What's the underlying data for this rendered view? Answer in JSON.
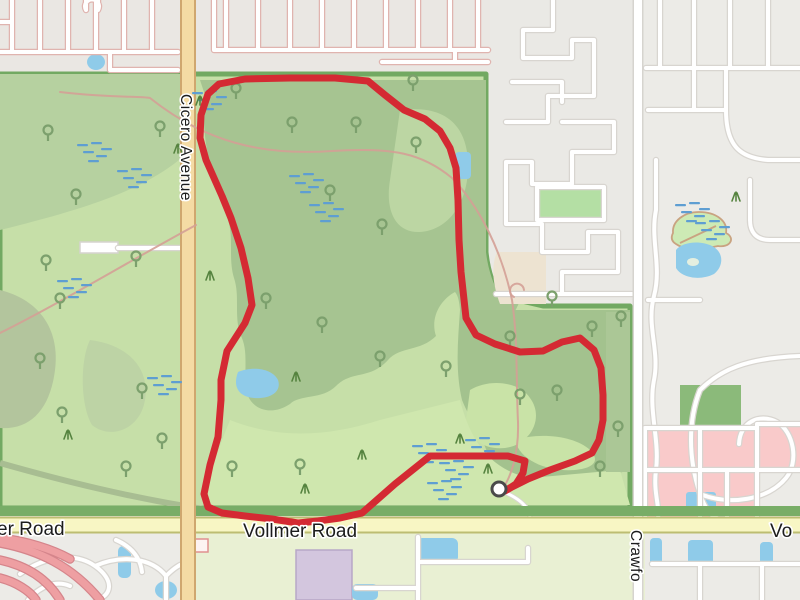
{
  "roads": {
    "cicero_label": "Cicero Avenue",
    "vollmer_label": "Vollmer Road",
    "vollmer_label_left_fragment": "er Road",
    "vollmer_label_right_fragment": "Vo",
    "crawford_label_fragment": "Crawfo"
  },
  "route": {
    "points": "505,491 516,484 523,473 525,461 508,456 470,456 430,456 395,484 362,513 340,518 318,521 298,523 272,519 245,516 222,513 208,507 204,494 210,465 218,437 221,400 221,380 227,351 245,323 252,305 248,278 241,248 231,218 222,196 206,160 200,138 201,115 208,94 219,84 245,79 290,78 335,78 368,81 385,95 404,110 425,119 440,131 450,148 456,168 458,200 459,240 461,272 466,318 476,335 495,344 520,352 543,351 562,342 580,338 594,350 601,368 603,395 603,420 599,440 592,453 575,461 550,470 528,479 512,487 505,491",
    "stroke_color": "#d42a33",
    "marker": {
      "x": 499,
      "y": 489,
      "fill": "#ffffff",
      "ring_color": "#4a4a4a",
      "radius": 7
    }
  },
  "park_symbols": {
    "trees": [
      [
        236,
        92
      ],
      [
        292,
        126
      ],
      [
        356,
        126
      ],
      [
        416,
        146
      ],
      [
        160,
        130
      ],
      [
        48,
        134
      ],
      [
        76,
        198
      ],
      [
        46,
        264
      ],
      [
        136,
        260
      ],
      [
        330,
        194
      ],
      [
        382,
        228
      ],
      [
        322,
        326
      ],
      [
        380,
        360
      ],
      [
        446,
        370
      ],
      [
        60,
        302
      ],
      [
        40,
        362
      ],
      [
        142,
        392
      ],
      [
        62,
        416
      ],
      [
        126,
        470
      ],
      [
        162,
        442
      ],
      [
        266,
        302
      ],
      [
        510,
        340
      ],
      [
        621,
        320
      ],
      [
        557,
        394
      ],
      [
        600,
        470
      ],
      [
        413,
        84
      ],
      [
        232,
        470
      ],
      [
        300,
        468
      ],
      [
        552,
        300
      ],
      [
        520,
        398
      ],
      [
        592,
        330
      ],
      [
        618,
        430
      ]
    ],
    "marsh_clusters": [
      [
        205,
        100
      ],
      [
        90,
        152
      ],
      [
        130,
        178
      ],
      [
        302,
        183
      ],
      [
        322,
        212
      ],
      [
        70,
        288
      ],
      [
        160,
        385
      ],
      [
        425,
        453
      ],
      [
        452,
        470
      ],
      [
        478,
        447
      ],
      [
        440,
        490
      ],
      [
        688,
        212
      ],
      [
        708,
        230
      ]
    ],
    "grass_tufts": [
      [
        178,
        150
      ],
      [
        210,
        277
      ],
      [
        296,
        378
      ],
      [
        68,
        436
      ],
      [
        305,
        490
      ],
      [
        362,
        456
      ],
      [
        488,
        470
      ],
      [
        736,
        198
      ],
      [
        460,
        440
      ],
      [
        200,
        102
      ]
    ]
  },
  "colors": {
    "city_background": "#ecebe7",
    "residential_nw_background": "#eae7e3",
    "park_green": "#c6dfa8",
    "woodland_green": "#a6c491",
    "open_grass_green": "#cfe7ae",
    "park_border_green": "#72a962",
    "verge_green": "#78ad67",
    "south_grass_green": "#e9f0d3",
    "trunk_road_fill": "#f4dba4",
    "trunk_road_casing": "#cfa76f",
    "secondary_road_fill": "#f8f6c4",
    "secondary_road_casing": "#bdbd72",
    "street_fill": "#ffffff",
    "street_casing": "#d8d5d0",
    "street_casing_pink": "#e0b4af",
    "water_blue": "#8fcbe9",
    "marsh_blue": "#5e9ed2",
    "tree_green": "#7ca06d",
    "grass_green": "#55833f",
    "retail_pink": "#f9caca",
    "ramp_pink": "#ee9fa2",
    "ramp_casing": "#d5858b",
    "building_purple": "#d3c6de",
    "parcel_beige": "#ede3d1",
    "parcel_green": "#b4dfa4",
    "label_text": "#1c1c1c"
  }
}
